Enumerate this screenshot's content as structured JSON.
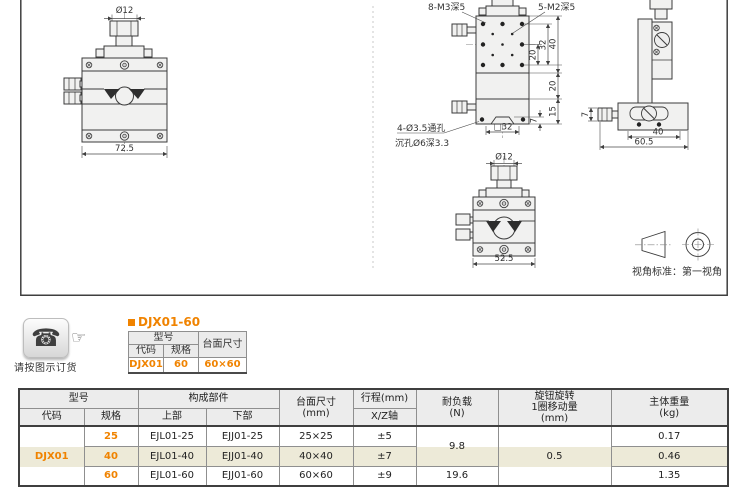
{
  "colors": {
    "accent_orange": "#f08300",
    "row_beige": "#edead8",
    "header_gray": "#ececec"
  },
  "drawing_area": {
    "front_view": {
      "dim_diameter": "Ø12",
      "dim_width": "72.5"
    },
    "top_view": {
      "label_m3": "8-M3深5",
      "label_m2": "5-M2深5",
      "dim_pitch": "20",
      "dim_span": "32",
      "dim_height": "40",
      "dim_mid": "20",
      "dim_base": "15",
      "dim_dovetail": "7",
      "dim_square": "□32",
      "label_thru_hole": "4-Ø3.5通孔",
      "label_counterbore": "沉孔Ø6深3.3"
    },
    "side_view": {
      "dim_knob": "7",
      "dim_body": "40",
      "dim_total": "60.5"
    },
    "bottom_view": {
      "dim_diameter": "Ø12",
      "dim_width": "52.5"
    },
    "projection_note": "视角标准：第一视角"
  },
  "ordering": {
    "phone_icon": "☎",
    "finger_icon": "☞",
    "caption": "请按图示订货",
    "title": "DJX01-60",
    "table": {
      "h_model": "型号",
      "h_code": "代码",
      "h_spec": "规格",
      "h_size": "台面尺寸",
      "code": "DJX01",
      "spec": "60",
      "size": "60×60"
    }
  },
  "spec_table": {
    "h_model": "型号",
    "h_code": "代码",
    "h_spec": "规格",
    "h_parts": "构成部件",
    "h_upper": "上部",
    "h_lower": "下部",
    "h_size_l1": "台面尺寸",
    "h_size_l2": "(mm)",
    "h_stroke": "行程(mm)",
    "h_axis": "X/Z轴",
    "h_load_l1": "耐负载",
    "h_load_l2": "(N)",
    "h_knob_l1": "旋钮旋转",
    "h_knob_l2": "1圈移动量",
    "h_knob_l3": "(mm)",
    "h_weight_l1": "主体重量",
    "h_weight_l2": "(kg)",
    "code": "DJX01",
    "rows": [
      {
        "spec": "25",
        "upper": "EJL01-25",
        "lower": "EJJ01-25",
        "size": "25×25",
        "stroke": "±5",
        "weight": "0.17"
      },
      {
        "spec": "40",
        "upper": "EJL01-40",
        "lower": "EJJ01-40",
        "size": "40×40",
        "stroke": "±7",
        "weight": "0.46"
      },
      {
        "spec": "60",
        "upper": "EJL01-60",
        "lower": "EJJ01-60",
        "size": "60×60",
        "stroke": "±9",
        "weight": "1.35"
      }
    ],
    "load_25_40": "9.8",
    "load_60": "19.6",
    "knob_travel": "0.5"
  }
}
